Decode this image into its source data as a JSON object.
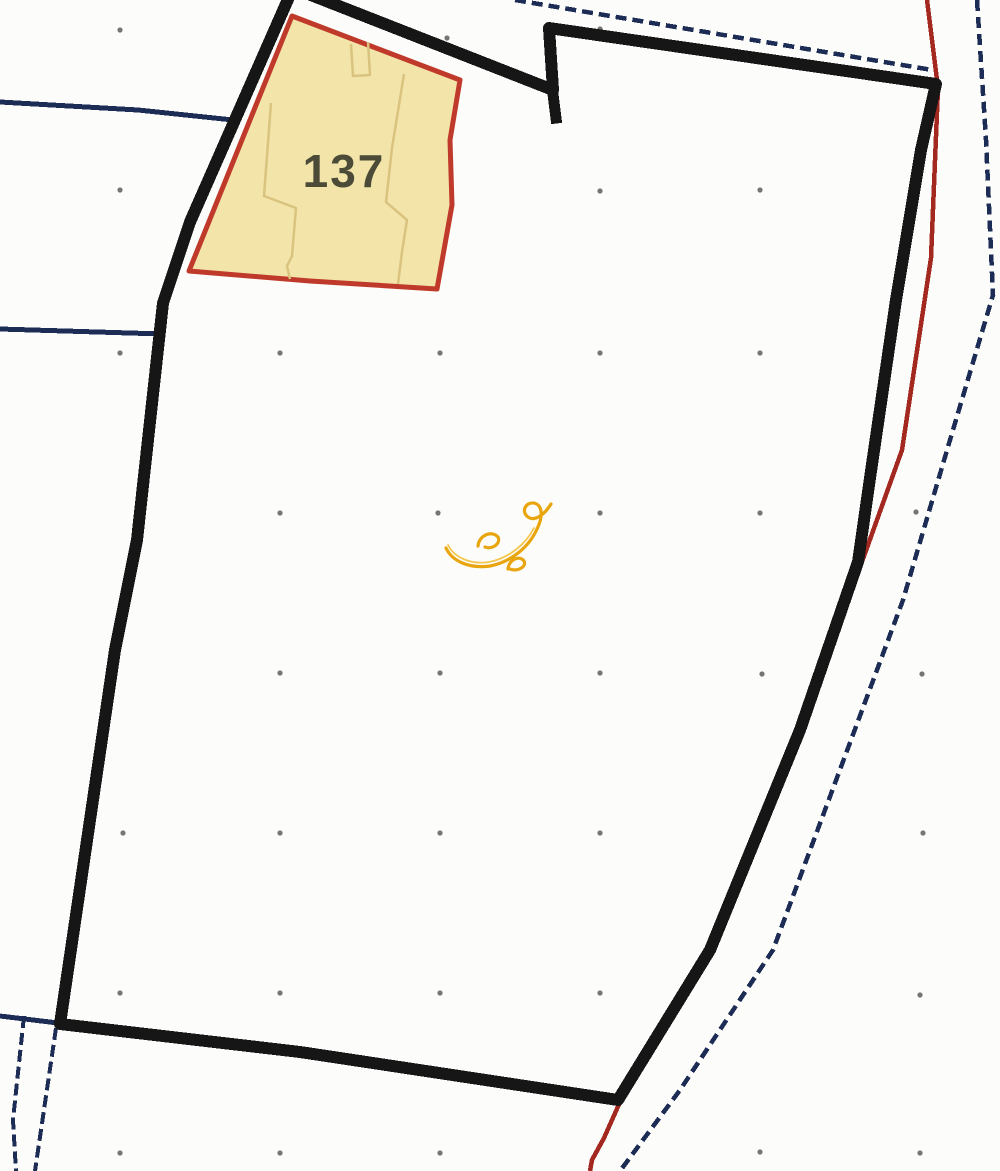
{
  "map": {
    "parcel": {
      "label": "137"
    },
    "colors": {
      "background": "#fcfcfa",
      "boundary_black": "#161616",
      "cadastral_blue": "#1d2c55",
      "cadastral_red": "#a3281f",
      "parcel_fill": "#f3e5a9",
      "parcel_border": "#c03a2b",
      "parcel_inner_lines": "#d9c37f",
      "parcel_label_text": "#4b4b38",
      "grid_dot": "#757575",
      "annotation_gold": "#e9a50d",
      "annotation_gold_light": "#f3c74f"
    },
    "grid_dots": [
      [
        120,
        30
      ],
      [
        447,
        38
      ],
      [
        600,
        29
      ],
      [
        120,
        190
      ],
      [
        600,
        191
      ],
      [
        760,
        190
      ],
      [
        120,
        353
      ],
      [
        280,
        353
      ],
      [
        440,
        353
      ],
      [
        600,
        353
      ],
      [
        760,
        353
      ],
      [
        280,
        513
      ],
      [
        438,
        513
      ],
      [
        600,
        513
      ],
      [
        760,
        513
      ],
      [
        916,
        512
      ],
      [
        280,
        673
      ],
      [
        440,
        673
      ],
      [
        600,
        673
      ],
      [
        762,
        674
      ],
      [
        922,
        674
      ],
      [
        123,
        833
      ],
      [
        280,
        833
      ],
      [
        440,
        833
      ],
      [
        600,
        833
      ],
      [
        923,
        833
      ],
      [
        120,
        993
      ],
      [
        280,
        993
      ],
      [
        440,
        993
      ],
      [
        600,
        993
      ],
      [
        920,
        995
      ],
      [
        120,
        1153
      ],
      [
        280,
        1153
      ],
      [
        440,
        1153
      ],
      [
        760,
        1152
      ],
      [
        920,
        1153
      ]
    ]
  }
}
